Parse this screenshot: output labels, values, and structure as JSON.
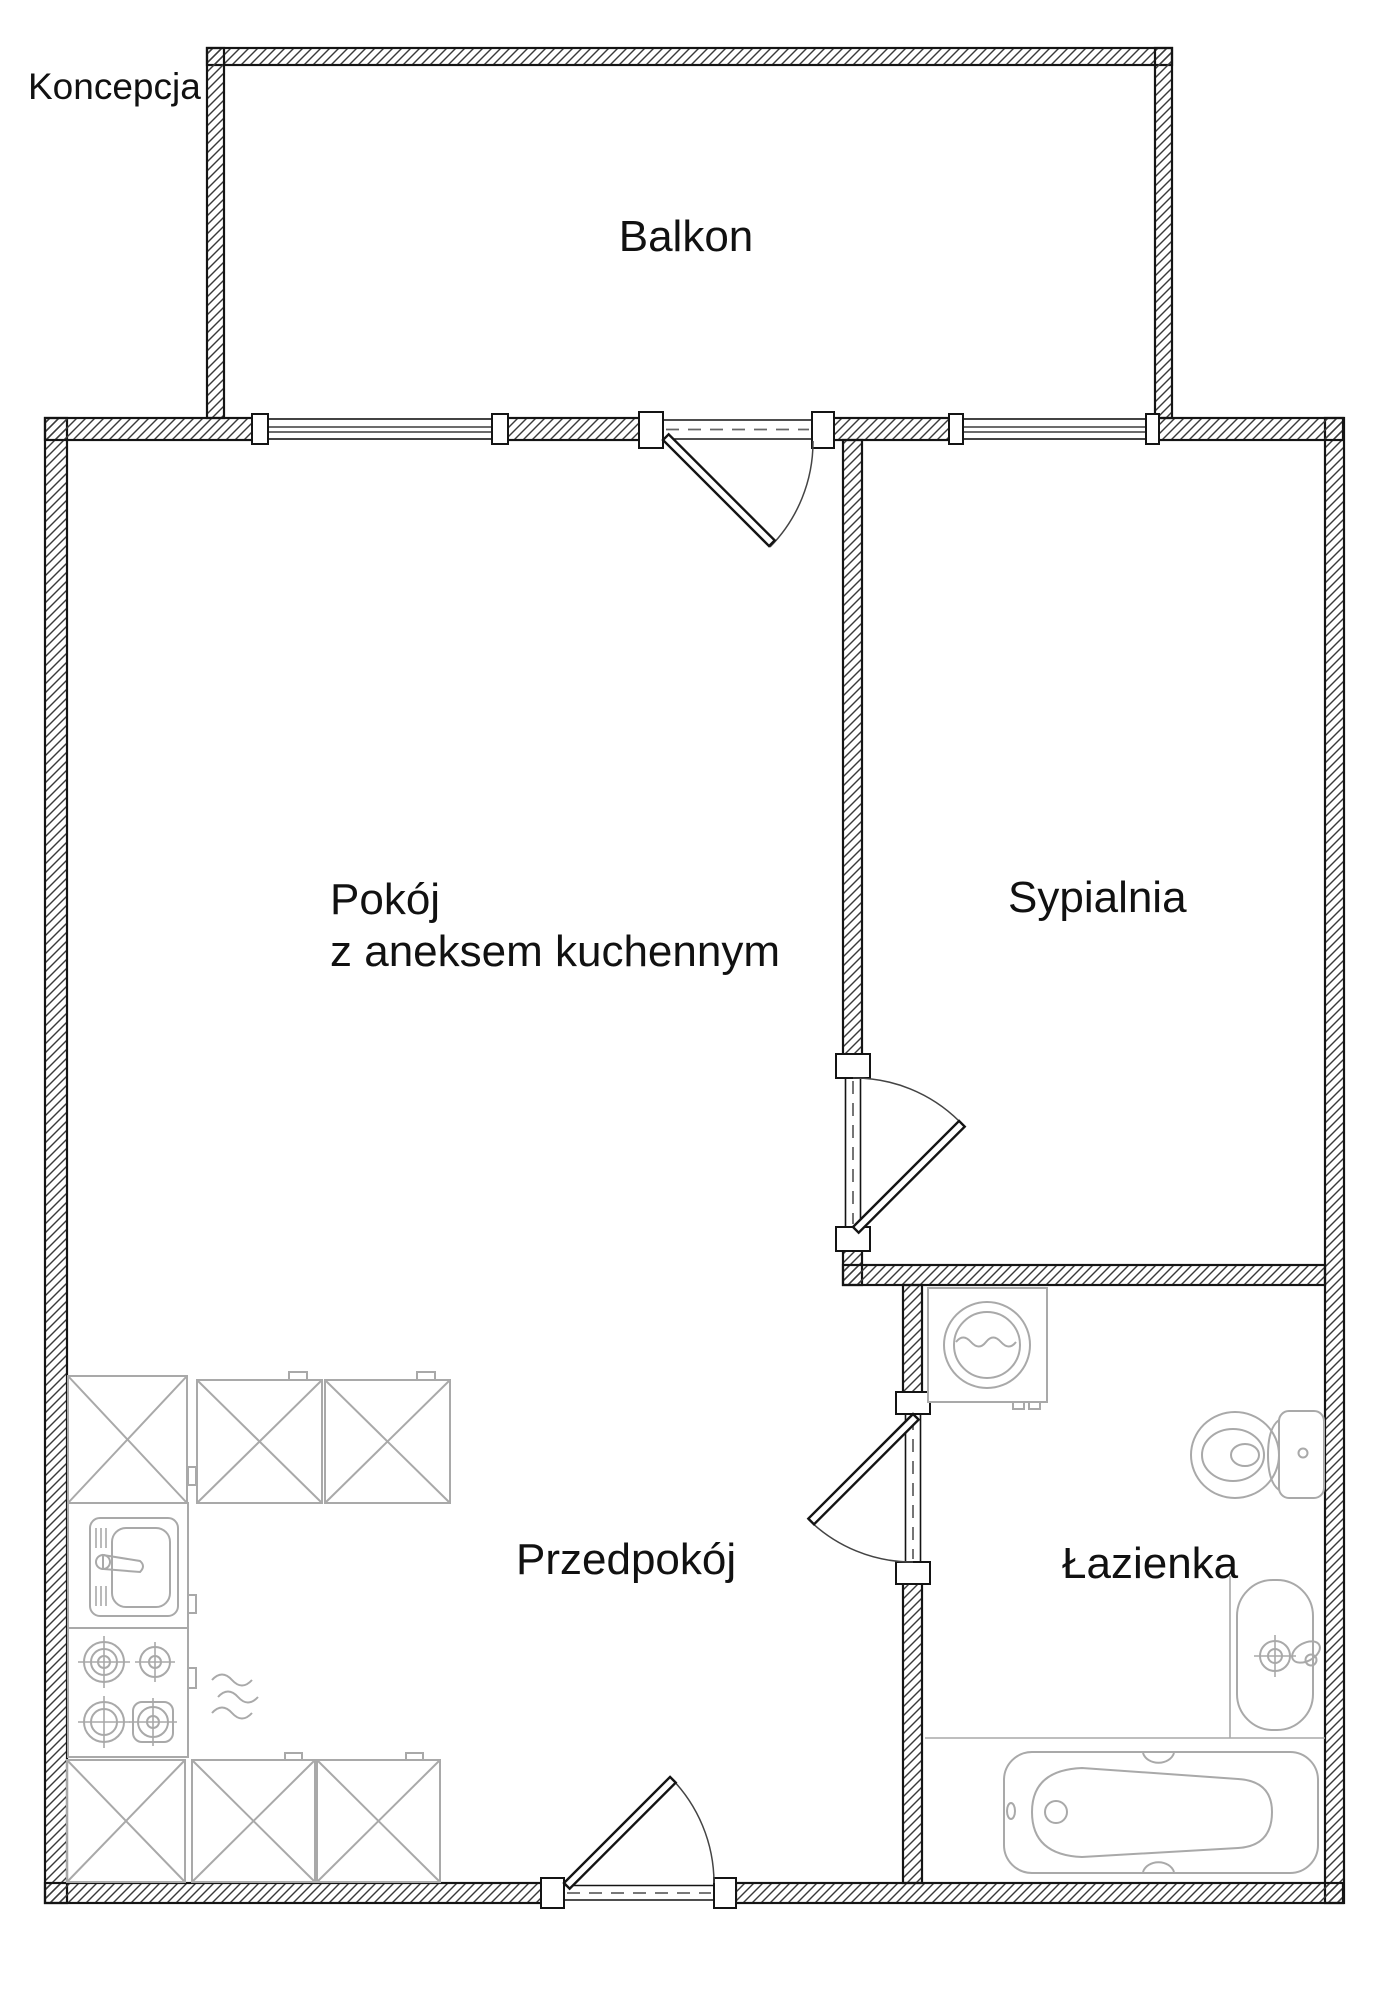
{
  "page": {
    "title": "Koncepcja"
  },
  "rooms": {
    "balkon": {
      "label": "Balkon"
    },
    "pokoj": {
      "label_line1": "Pokój",
      "label_line2": "z aneksem kuchennym"
    },
    "sypialnia": {
      "label": "Sypialnia"
    },
    "przedpokoj": {
      "label": "Przedpokój"
    },
    "lazienka": {
      "label": "Łazienka"
    }
  },
  "fixtures": {
    "kitchen": [
      "corner-base-cabinet",
      "base-cabinet",
      "base-cabinet",
      "kitchen-sink",
      "cooktop-4-burner",
      "vent-squiggle",
      "corner-base-cabinet",
      "base-cabinet",
      "base-cabinet"
    ],
    "bathroom": [
      "washing-machine",
      "toilet",
      "washbasin",
      "bathtub"
    ]
  },
  "colors": {
    "wall_line": "#141414",
    "hatch": "#3a3a3a",
    "fixture_gray": "#a9a9a9",
    "dash": "#666666",
    "text": "#111111",
    "background": "#ffffff"
  }
}
